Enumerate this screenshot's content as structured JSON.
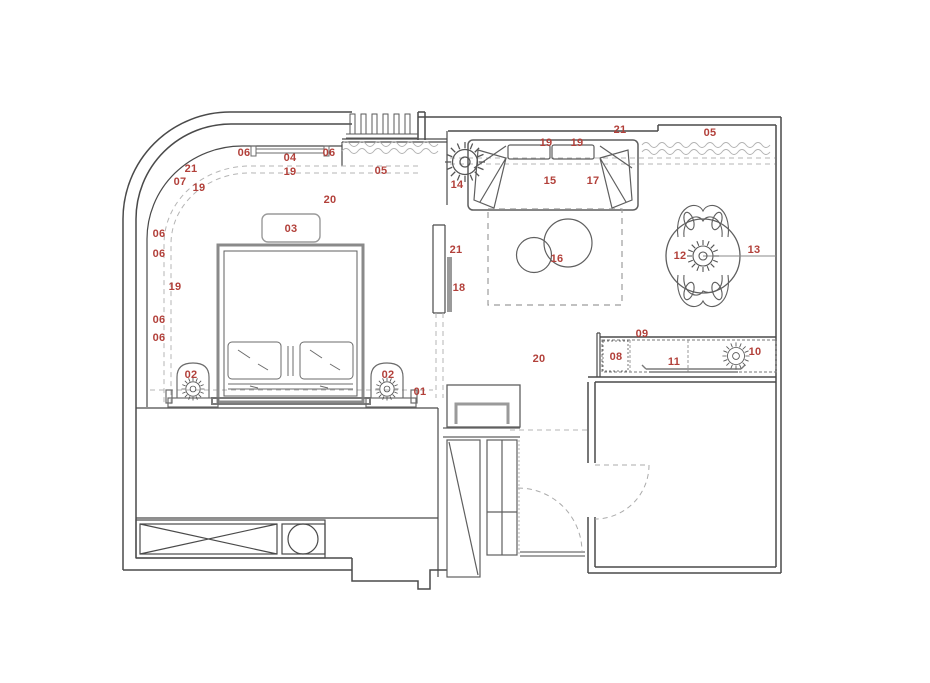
{
  "colors": {
    "accent": "#b2403a",
    "wall_line": "#4a4a4a",
    "furniture_line": "#6b6b6b",
    "light_line": "#9a9a9a",
    "dash_line": "#b5b5b5",
    "background": "#ffffff"
  },
  "icons": [
    {
      "name": "radial-lamp-icon"
    },
    {
      "name": "pendant-light-icon"
    },
    {
      "name": "door-swing-icon"
    },
    {
      "name": "radiator-icon"
    },
    {
      "name": "curtain-wave-icon"
    }
  ],
  "plan": {
    "labels": [
      {
        "text": "06",
        "x": 244,
        "y": 153
      },
      {
        "text": "04",
        "x": 290,
        "y": 158
      },
      {
        "text": "06",
        "x": 329,
        "y": 153
      },
      {
        "text": "19",
        "x": 290,
        "y": 172
      },
      {
        "text": "05",
        "x": 381,
        "y": 171
      },
      {
        "text": "21",
        "x": 191,
        "y": 169
      },
      {
        "text": "07",
        "x": 180,
        "y": 182
      },
      {
        "text": "19",
        "x": 199,
        "y": 188
      },
      {
        "text": "20",
        "x": 330,
        "y": 200
      },
      {
        "text": "03",
        "x": 291,
        "y": 229
      },
      {
        "text": "06",
        "x": 159,
        "y": 234
      },
      {
        "text": "06",
        "x": 159,
        "y": 254
      },
      {
        "text": "19",
        "x": 175,
        "y": 287
      },
      {
        "text": "06",
        "x": 159,
        "y": 320
      },
      {
        "text": "06",
        "x": 159,
        "y": 338
      },
      {
        "text": "02",
        "x": 191,
        "y": 375
      },
      {
        "text": "02",
        "x": 388,
        "y": 375
      },
      {
        "text": "01",
        "x": 420,
        "y": 392
      },
      {
        "text": "19",
        "x": 546,
        "y": 143
      },
      {
        "text": "19",
        "x": 577,
        "y": 143
      },
      {
        "text": "21",
        "x": 620,
        "y": 130
      },
      {
        "text": "05",
        "x": 710,
        "y": 133
      },
      {
        "text": "14",
        "x": 457,
        "y": 185
      },
      {
        "text": "15",
        "x": 550,
        "y": 181
      },
      {
        "text": "17",
        "x": 593,
        "y": 181
      },
      {
        "text": "21",
        "x": 456,
        "y": 250
      },
      {
        "text": "18",
        "x": 459,
        "y": 288
      },
      {
        "text": "16",
        "x": 557,
        "y": 259
      },
      {
        "text": "12",
        "x": 680,
        "y": 256
      },
      {
        "text": "13",
        "x": 754,
        "y": 250
      },
      {
        "text": "09",
        "x": 642,
        "y": 334
      },
      {
        "text": "08",
        "x": 616,
        "y": 357
      },
      {
        "text": "11",
        "x": 674,
        "y": 362
      },
      {
        "text": "10",
        "x": 755,
        "y": 352
      },
      {
        "text": "20",
        "x": 539,
        "y": 359
      }
    ]
  }
}
